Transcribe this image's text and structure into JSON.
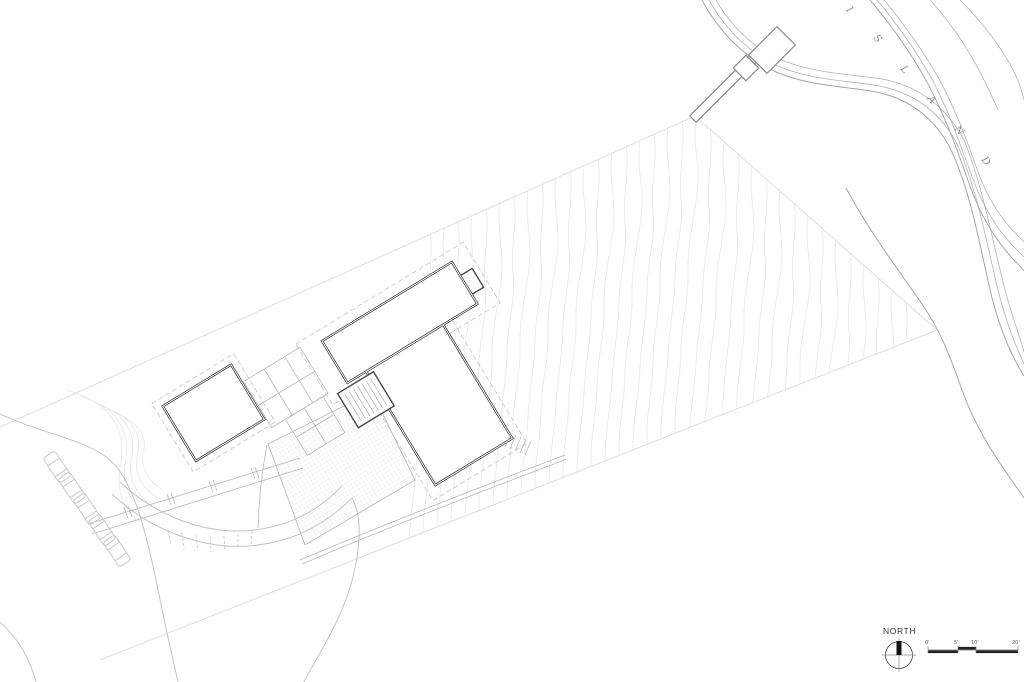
{
  "compass": {
    "label": "NORTH"
  },
  "scale_bar": {
    "labels": [
      "0'",
      "5'",
      "10'",
      "20'"
    ]
  },
  "island_label": {
    "word": "ISLAND",
    "letters": [
      "I",
      "S",
      "L",
      "A",
      "N",
      "D"
    ]
  },
  "colors": {
    "background": "#ffffff",
    "wall": "#3f3f3f",
    "structure": "#8a8a8a",
    "shore": "#a6a6a6",
    "site": "#c4c4c4",
    "boundary": "#dedede",
    "contour": "#e8e8e8",
    "hatch": "#e0e0e0",
    "label": "#8f8f8f",
    "text": "#333333"
  }
}
